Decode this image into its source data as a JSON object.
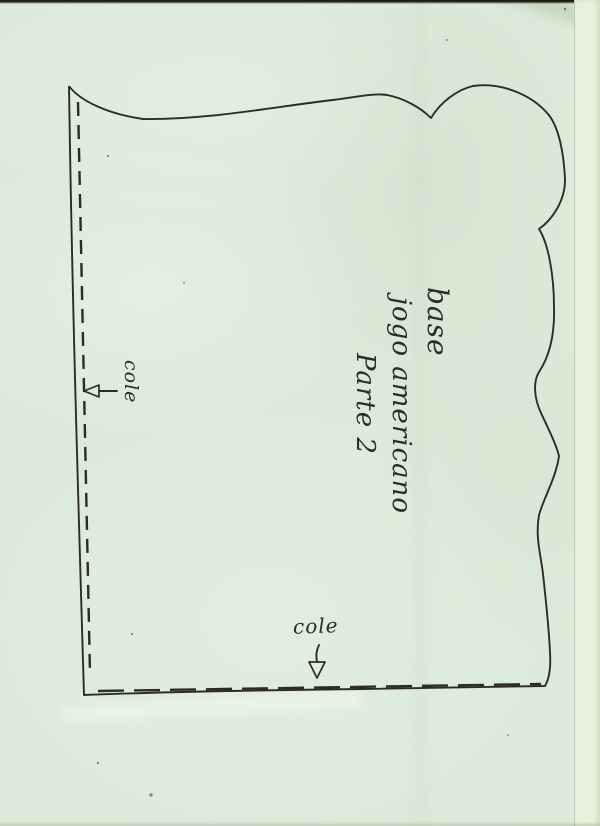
{
  "colors": {
    "paper": "#dcebd9",
    "paper_edge_strip": "#e8f1dc",
    "ink": "#2e2b26"
  },
  "pattern": {
    "center_label_lines": [
      "base",
      "jogo americano",
      "Parte 2"
    ],
    "left_glue_label": "cole",
    "bottom_glue_label": "cole"
  }
}
